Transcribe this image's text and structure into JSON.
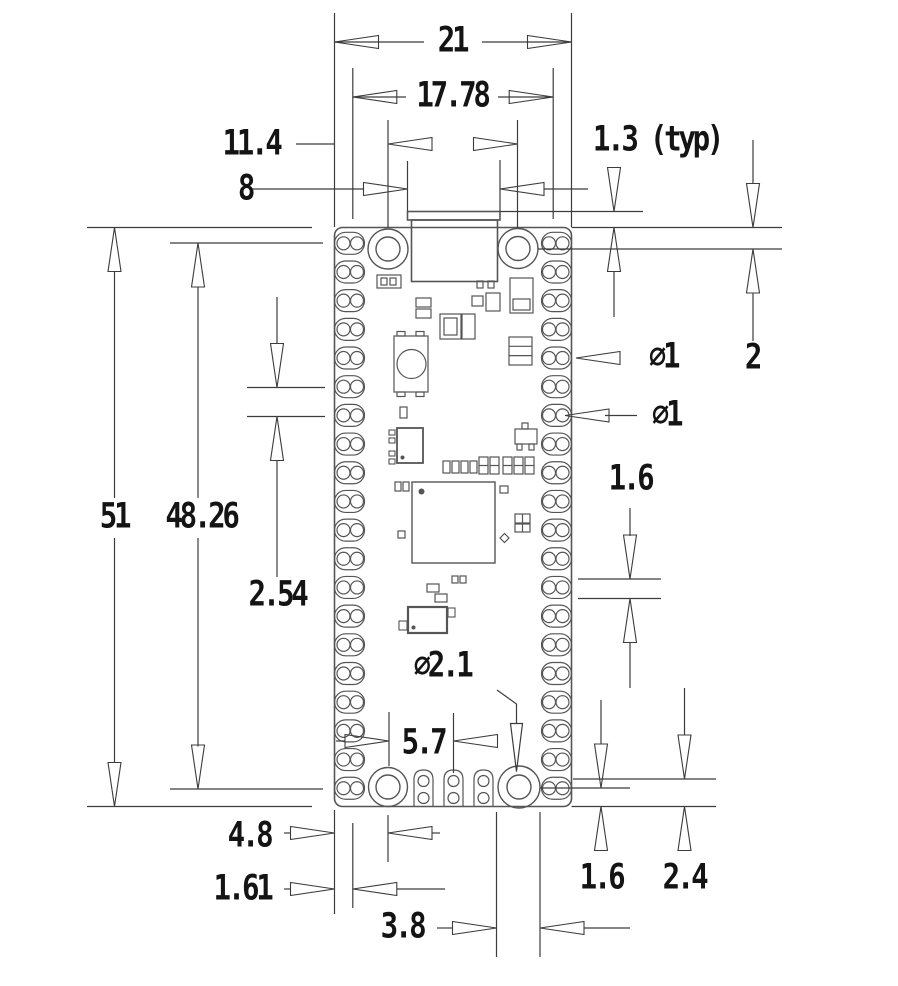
{
  "figure": {
    "type": "mechanical dimension drawing",
    "subject": "Raspberry Pi Pico board outline with castellated pads, USB connector, BOOTSEL button and mounting holes (top view)",
    "units": "mm"
  },
  "dimensions": {
    "board_width": "21",
    "pad_column_span": "17.78",
    "top_hole_spacing": "11.4",
    "usb_connector_width": "8",
    "usb_overhang": "1.3 (typ)",
    "top_hole_edge_offset": "2",
    "castellated_hole_diameter": "∅1",
    "through_hole_diameter": "∅1",
    "pad_length": "1.6",
    "board_length": "51",
    "pad_row_span": "48.26",
    "pad_pitch": "2.54",
    "mounting_hole_diameter": "∅2.1",
    "debug_pad_offset": "5.7",
    "bottom_hole_x_offset": "4.8",
    "castellation_depth": "1.61",
    "bottom_pad_ring": "3.8",
    "bottom_offset_inner": "1.6",
    "bottom_hole_y_offset": "2.4"
  }
}
